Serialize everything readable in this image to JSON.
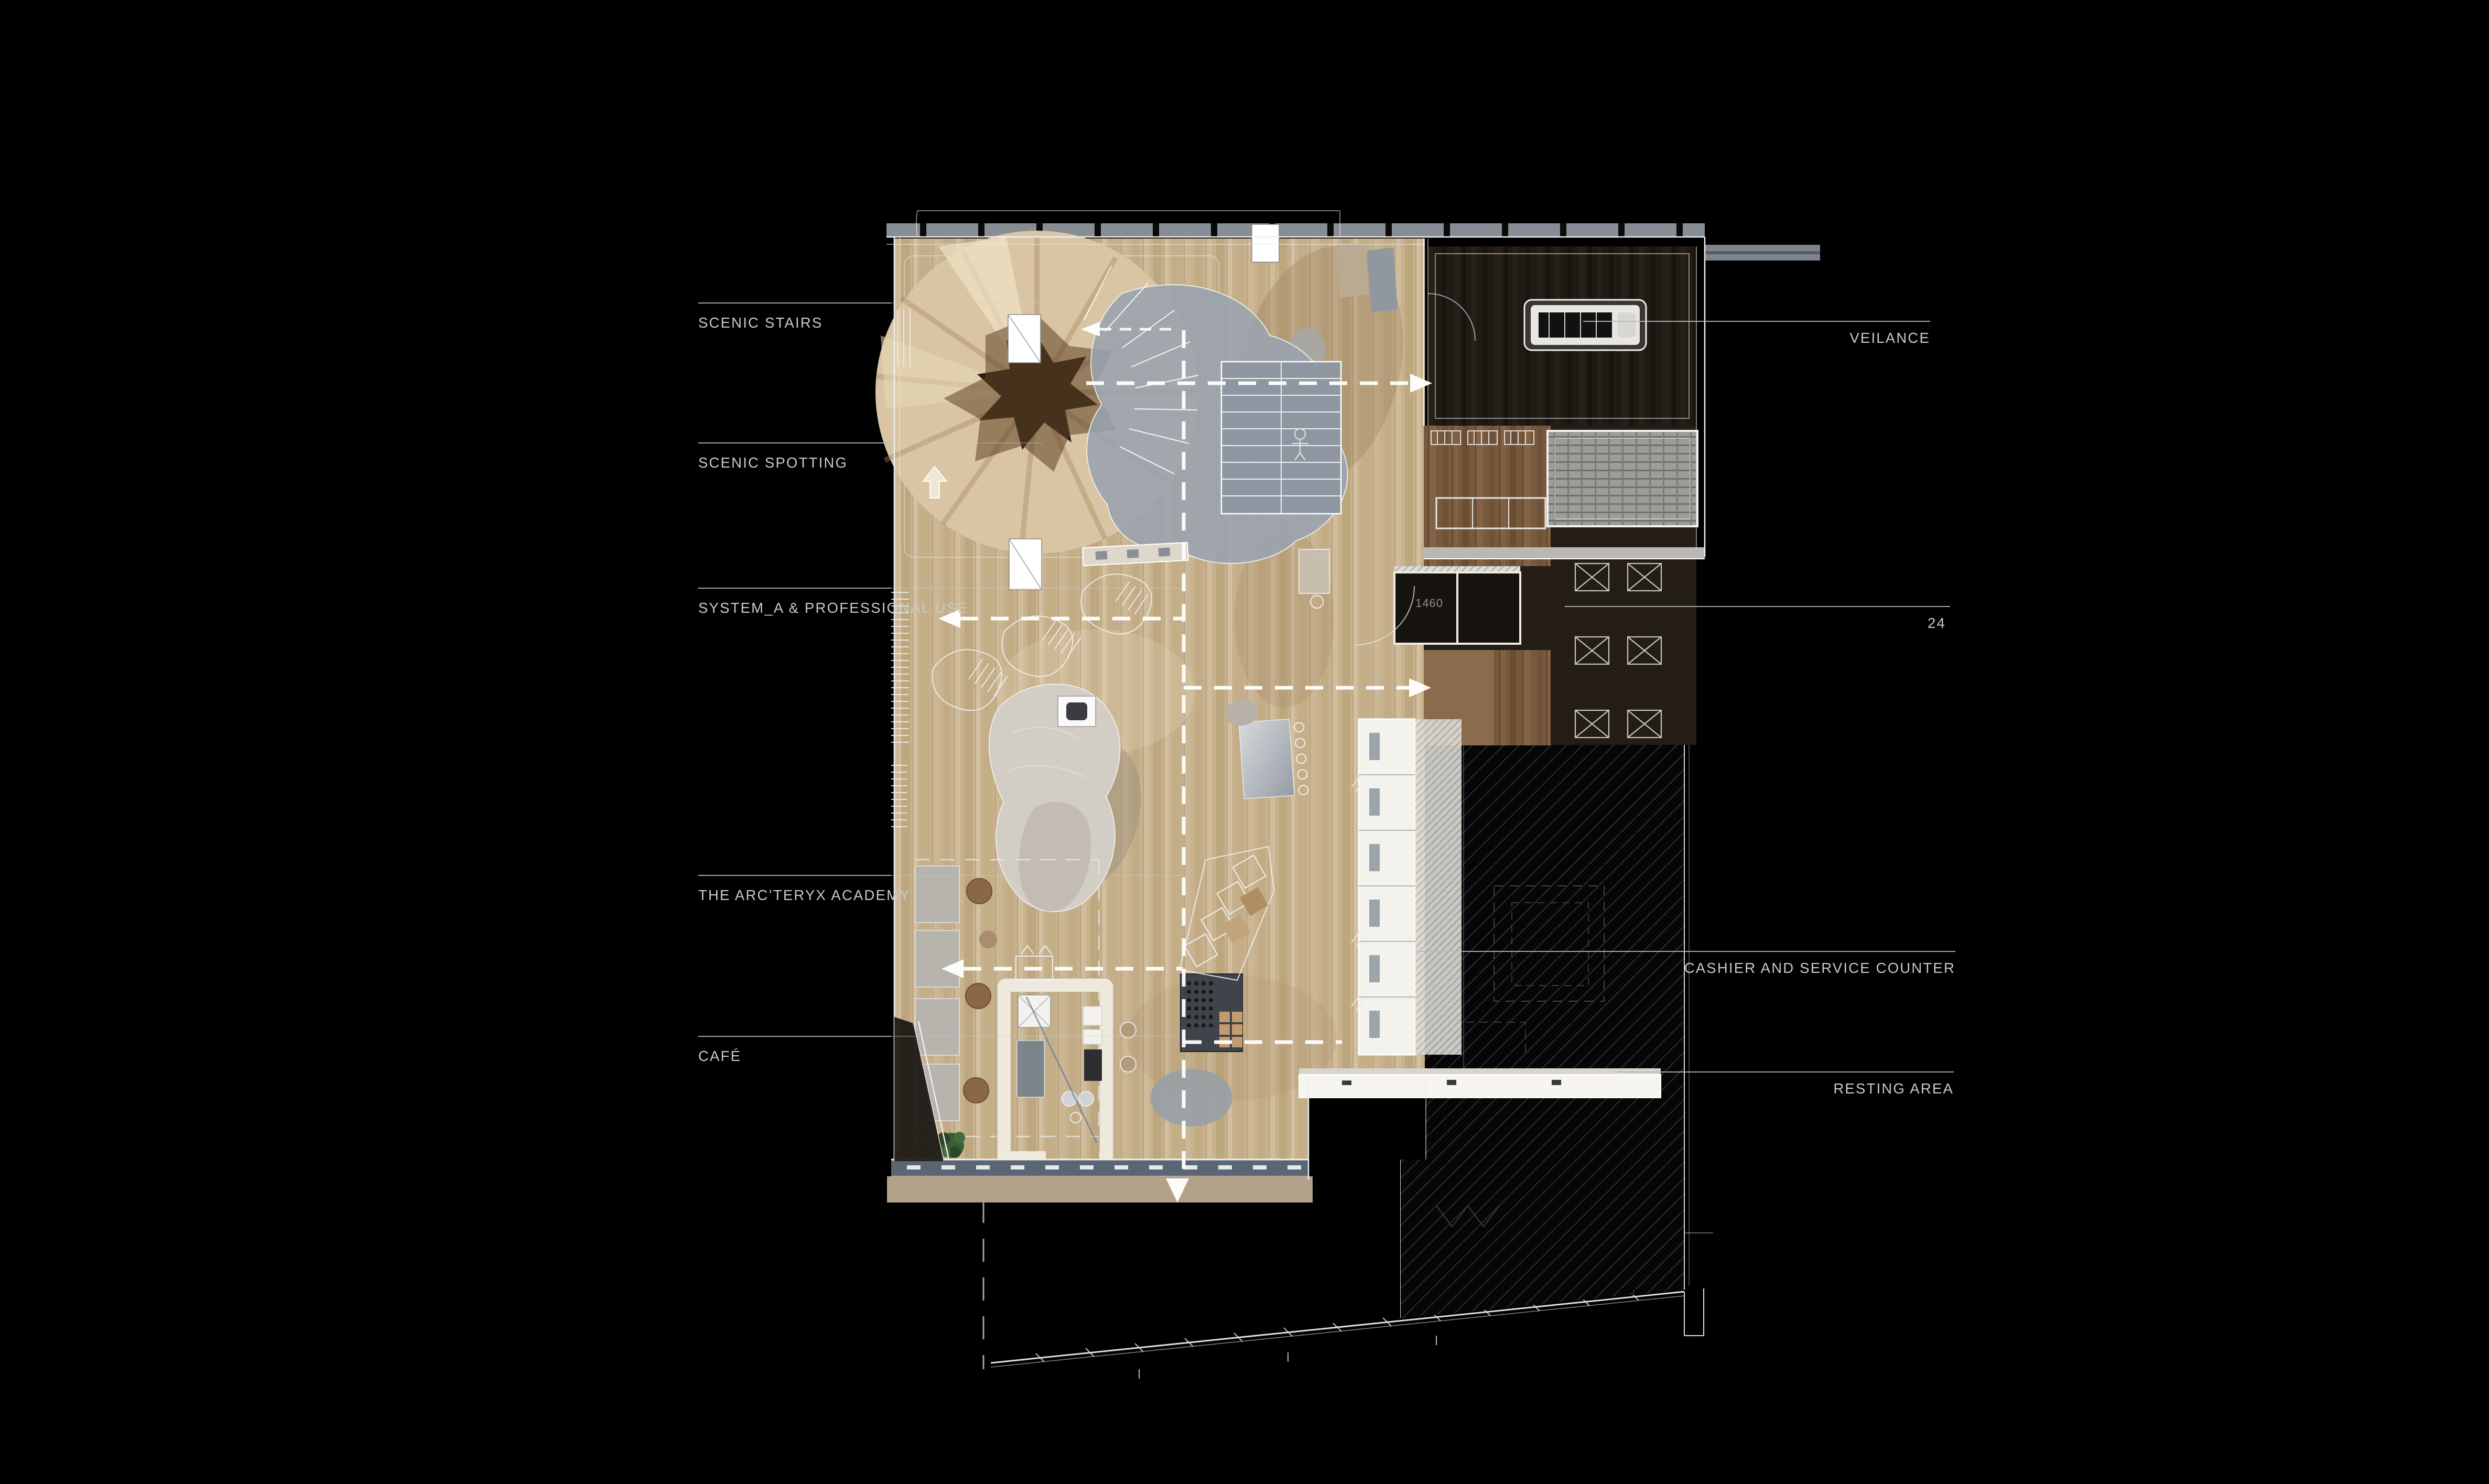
{
  "page": {
    "kind": "architectural-floor-plan-rendering",
    "background": "#000000"
  },
  "labels": {
    "left": [
      {
        "id": "scenic-stairs",
        "text": "SCENIC STAIRS"
      },
      {
        "id": "scenic-spotting",
        "text": "SCENIC SPOTTING"
      },
      {
        "id": "system-a",
        "text": "SYSTEM_A & PROFESSIONAL USE"
      },
      {
        "id": "academy",
        "text": "THE ARC’TERYX ACADEMY"
      },
      {
        "id": "cafe",
        "text": "CAFÉ"
      }
    ],
    "right": [
      {
        "id": "veilance",
        "text": "VEILANCE"
      },
      {
        "id": "unit-24",
        "text": "24"
      },
      {
        "id": "cashier",
        "text": "CASHIER AND SERVICE COUNTER"
      },
      {
        "id": "resting",
        "text": "RESTING AREA"
      }
    ]
  },
  "annotations": {
    "dimension": "1460"
  },
  "icons": {
    "arrow_right": "right-pointing triangle",
    "arrow_left": "left-pointing triangle",
    "arrow_up": "up-pointing arrow",
    "arrow_down": "down-pointing triangle"
  },
  "colors": {
    "background": "#000000",
    "label_text": "#c9c9c9",
    "leader_line": "#b9b9b9",
    "wood_floor": "#c8b28e",
    "wood_dark": "#77593c",
    "dark_room": "#1f1a14",
    "hatch_line": "#2e2e2e",
    "counter_white": "#f2efe8",
    "glazing_blue": "#5a6674",
    "sidewalk_tan": "#b3a289",
    "facade_gray": "#878d94",
    "roof_bar_gray": "#7d848c",
    "path_dash": "#ffffff"
  }
}
